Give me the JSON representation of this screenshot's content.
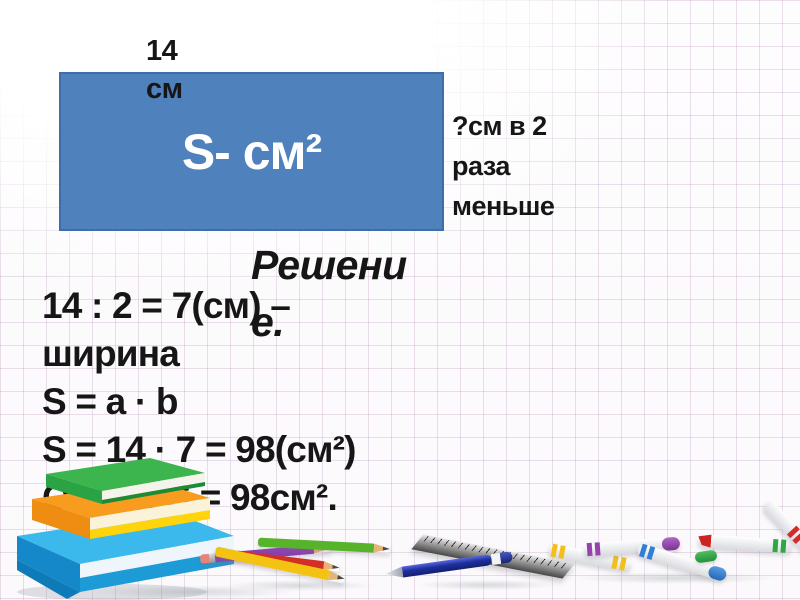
{
  "diagram": {
    "top_label": "14 см",
    "area_label": "S- см²",
    "right_label": "?см в 2 раза меньше",
    "rect_color": "#4f81bd",
    "rect_border_color": "#3f6da8"
  },
  "heading": {
    "text": "Решение.",
    "line1": "Решени",
    "line2": "е."
  },
  "solution": {
    "lines": [
      "14 : 2 = 7(см) –",
      "ширина",
      "S = a · b",
      "S = 14 · 7 = 98(см²)",
      "Ответ: S = 98см²."
    ]
  },
  "decorations": {
    "grid_color": "#b896bc",
    "books_stack_colors": [
      "#3cb54e",
      "#f89c20",
      "#ffd40a",
      "#3bb8ec"
    ],
    "pencils": [
      {
        "name": "purple-pencil",
        "color": "#8d3fb0"
      },
      {
        "name": "green-pencil",
        "color": "#56b32a"
      },
      {
        "name": "red-pencil",
        "color": "#d42f26"
      },
      {
        "name": "yellow-pencil",
        "color": "#f4c212"
      }
    ],
    "pen_color": "#1f2f9e",
    "ruler_color": "#9c9c9c",
    "markers": [
      {
        "name": "yellow-marker",
        "color": "#f2c01d"
      },
      {
        "name": "purple-marker",
        "color": "#9543ad"
      },
      {
        "name": "blue-marker",
        "color": "#2f7fd4"
      },
      {
        "name": "green-marker",
        "color": "#2fa842"
      },
      {
        "name": "red-marker",
        "color": "#d62b2b"
      }
    ]
  }
}
